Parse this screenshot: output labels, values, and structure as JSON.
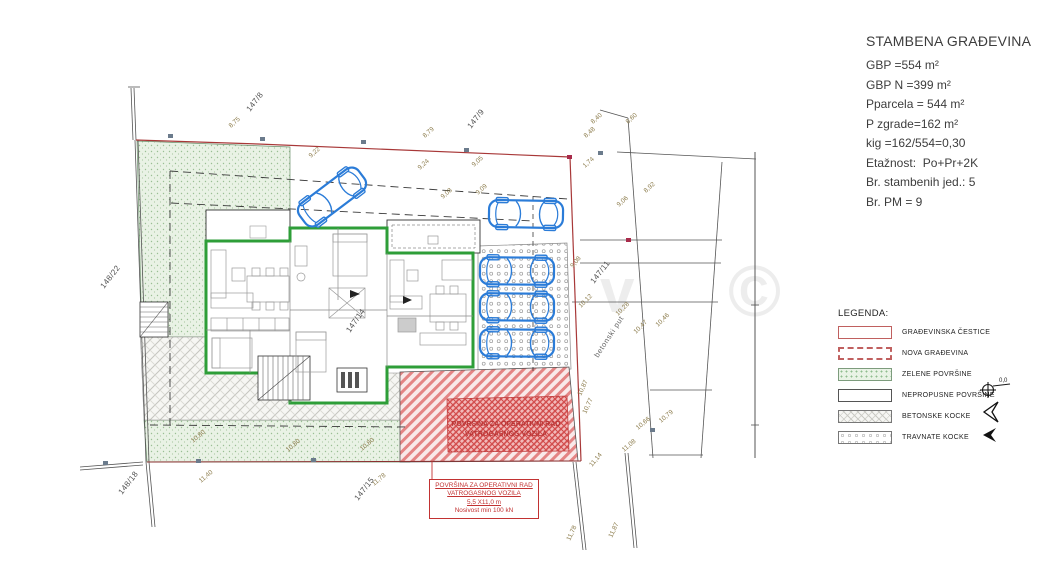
{
  "title_block": {
    "title": "STAMBENA GRAĐEVINA",
    "lines": [
      "GBP =554 m²",
      "GBP N =399 m²",
      "Pparcela = 544 m²",
      "P zgrade=162 m²",
      "kig =162/554=0,30",
      "Etažnost:  Po+Pr+2K",
      "Br. stambenih jed.: 5",
      "Br. PM = 9"
    ]
  },
  "legend": {
    "heading": "LEGENDA:",
    "items": [
      {
        "label": "GRAĐEVINSKA ČESTICE",
        "swatch": "plot"
      },
      {
        "label": "NOVA GRAĐEVINA",
        "swatch": "newb"
      },
      {
        "label": "ZELENE POVRŠINE",
        "swatch": "green"
      },
      {
        "label": "NEPROPUSNE POVRŠINE",
        "swatch": "white"
      },
      {
        "label": "BETONSKE KOCKE",
        "swatch": "beton"
      },
      {
        "label": "TRAVNATE KOCKE",
        "swatch": "trav"
      }
    ]
  },
  "symbols": {
    "benchmark_label": "0,0"
  },
  "fire_area_label": {
    "line1": "POVRŠINA ZA OPERATIVNI RAD",
    "line2": "VATROGASNOG VOZILA",
    "line3": "5,5 X11,0 m",
    "line4": "Nosivost min 100 kN"
  },
  "plan": {
    "parcel_labels": [
      {
        "text": "147/8",
        "x": 250,
        "y": 112,
        "r": -52
      },
      {
        "text": "147/9",
        "x": 471,
        "y": 129,
        "r": -52
      },
      {
        "text": "148/22",
        "x": 104,
        "y": 289,
        "r": -52
      },
      {
        "text": "148/18",
        "x": 122,
        "y": 495,
        "r": -52
      },
      {
        "text": "147/15",
        "x": 358,
        "y": 501,
        "r": -52
      },
      {
        "text": "147/11",
        "x": 594,
        "y": 284,
        "r": -52
      },
      {
        "text": "147/14",
        "x": 350,
        "y": 333,
        "r": -55
      }
    ],
    "road_label": {
      "text": "betonski put",
      "x": 598,
      "y": 358,
      "r": -57
    },
    "dimension_labels": [
      {
        "text": "8,75",
        "x": 231,
        "y": 128,
        "r": -42
      },
      {
        "text": "9,22",
        "x": 311,
        "y": 158,
        "r": -42
      },
      {
        "text": "8,79",
        "x": 425,
        "y": 138,
        "r": -42
      },
      {
        "text": "9,24",
        "x": 420,
        "y": 170,
        "r": -42
      },
      {
        "text": "9,05",
        "x": 474,
        "y": 167,
        "r": -42
      },
      {
        "text": "9,09",
        "x": 478,
        "y": 195,
        "r": -42
      },
      {
        "text": "9,08",
        "x": 443,
        "y": 199,
        "r": -42
      },
      {
        "text": "8,40",
        "x": 593,
        "y": 124,
        "r": -42
      },
      {
        "text": "8,48",
        "x": 586,
        "y": 138,
        "r": -42
      },
      {
        "text": "8,60",
        "x": 628,
        "y": 124,
        "r": -42
      },
      {
        "text": "1,74",
        "x": 585,
        "y": 168,
        "r": -42
      },
      {
        "text": "8,92",
        "x": 646,
        "y": 193,
        "r": -42
      },
      {
        "text": "9,06",
        "x": 619,
        "y": 207,
        "r": -42
      },
      {
        "text": "9,08",
        "x": 573,
        "y": 268,
        "r": -50
      },
      {
        "text": "10,12",
        "x": 581,
        "y": 308,
        "r": -45
      },
      {
        "text": "10,28",
        "x": 618,
        "y": 316,
        "r": -45
      },
      {
        "text": "10,47",
        "x": 636,
        "y": 334,
        "r": -45
      },
      {
        "text": "10,46",
        "x": 658,
        "y": 327,
        "r": -45
      },
      {
        "text": "10,87",
        "x": 581,
        "y": 396,
        "r": -65
      },
      {
        "text": "10,77",
        "x": 586,
        "y": 414,
        "r": -65
      },
      {
        "text": "10,79",
        "x": 661,
        "y": 423,
        "r": -40
      },
      {
        "text": "10,66",
        "x": 638,
        "y": 430,
        "r": -40
      },
      {
        "text": "11,08",
        "x": 624,
        "y": 452,
        "r": -40
      },
      {
        "text": "11,14",
        "x": 592,
        "y": 467,
        "r": -50
      },
      {
        "text": "11,78",
        "x": 570,
        "y": 541,
        "r": -65
      },
      {
        "text": "11,87",
        "x": 612,
        "y": 538,
        "r": -65
      },
      {
        "text": "10,80",
        "x": 193,
        "y": 443,
        "r": -40
      },
      {
        "text": "10,80",
        "x": 288,
        "y": 452,
        "r": -40
      },
      {
        "text": "10,80",
        "x": 362,
        "y": 451,
        "r": -40
      },
      {
        "text": "11,40",
        "x": 201,
        "y": 483,
        "r": -40
      },
      {
        "text": "11,78",
        "x": 374,
        "y": 486,
        "r": -40
      }
    ],
    "watermark": [
      {
        "text": "v",
        "x": 600,
        "y": 312,
        "size": 62
      },
      {
        "text": "©",
        "x": 728,
        "y": 316,
        "size": 72
      }
    ]
  },
  "colors": {
    "boundary_red": "#a83838",
    "wall_green": "#2e9e38",
    "car_blue": "#2b7cd8",
    "green_fill": "#e9f2e5",
    "fire_red": "#d94b4b",
    "dim_text": "#8c7c4c"
  }
}
